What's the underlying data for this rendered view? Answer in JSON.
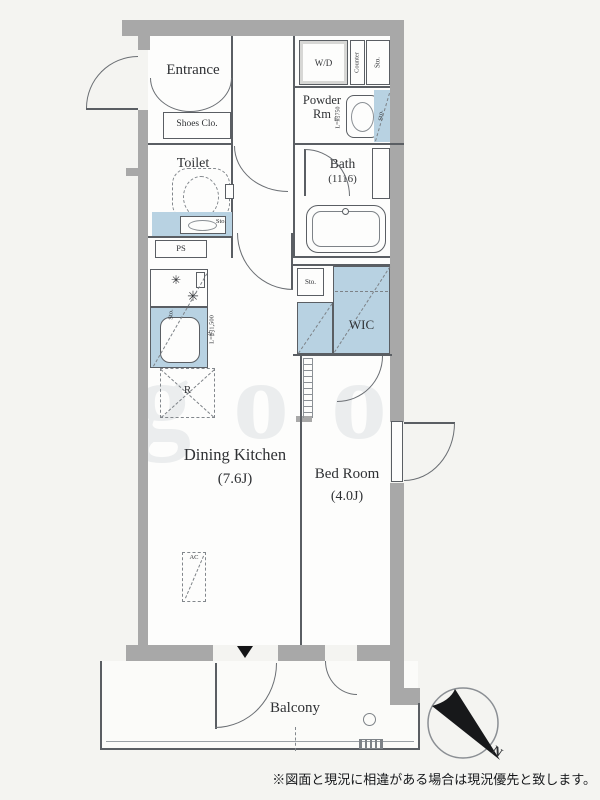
{
  "colors": {
    "wall": "#a8a8a8",
    "storage_blue": "#b8d2e2",
    "line": "#5a5e63",
    "background": "#f4f4f1"
  },
  "plan": {
    "rooms": {
      "entrance": "Entrance",
      "shoes_closet": "Shoes Clo.",
      "toilet": "Toilet",
      "powder_room": "Powder Rm",
      "bath": "Bath",
      "bath_size": "(1116)",
      "dining_kitchen": "Dining Kitchen",
      "dining_kitchen_size": "(7.6J)",
      "bedroom": "Bed Room",
      "bedroom_size": "(4.0J)",
      "wic": "WIC",
      "balcony": "Balcony"
    },
    "fixtures": {
      "washer_dryer": "W/D",
      "counter": "Counter",
      "storage": "Sto.",
      "pipe_space": "PS",
      "refrigerator": "R",
      "air_conditioner": "AC",
      "powder_sink_length": "L=約750",
      "kitchen_counter_length": "L=約1,500"
    },
    "compass": {
      "north": "N"
    },
    "watermark": "goo",
    "disclaimer": "※図面と現況に相違がある場合は現況優先と致します。"
  }
}
